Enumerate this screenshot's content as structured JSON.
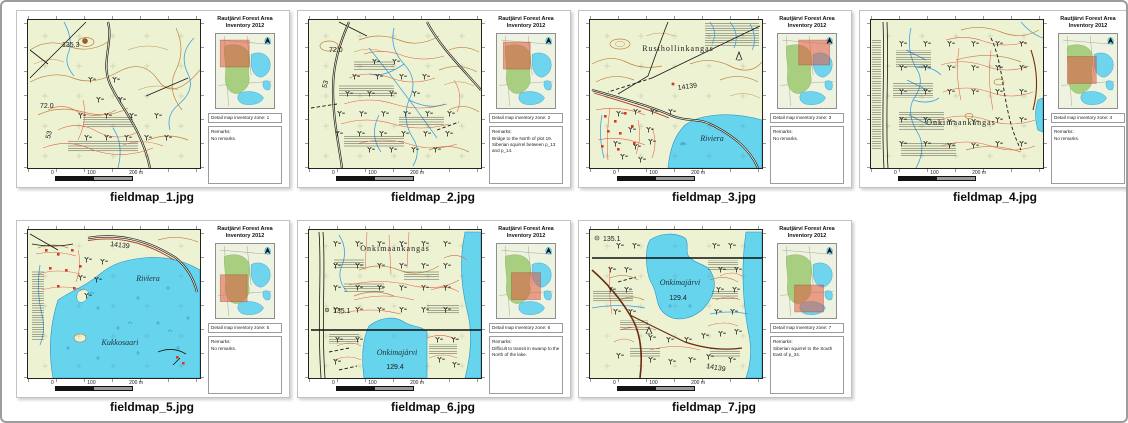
{
  "window": {
    "background": "#ffffff",
    "border_color": "#9c9c9c"
  },
  "card_common": {
    "title_line1": "Rautjärvi Forest Area",
    "title_line2": "Inventory 2012",
    "remarks_heading": "Remarks:",
    "scalebar_ticks": [
      "0",
      "100",
      "200 m"
    ],
    "north_arrow": "north"
  },
  "colors": {
    "map_background": "#edf3d2",
    "lake_fill": "#67d4ee",
    "contour_orange": "#c0813e",
    "detail_red": "#e2604a",
    "stream_blue": "#3f9fe0",
    "road_black": "#161616",
    "overview_forest_green": "#a8cf80",
    "overview_water_cyan": "#6fd4ee",
    "zone_highlight_red": "#e05a43"
  },
  "maps": [
    {
      "caption": "fieldmap_1.jpg",
      "zone_label": "Detail map inventory zone: 1",
      "remarks": "No remarks.",
      "labels": {
        "spot_height": "135.3",
        "contour_elev": "72.0",
        "road_number": "53"
      }
    },
    {
      "caption": "fieldmap_2.jpg",
      "zone_label": "Detail map inventory zone: 2",
      "remarks": "Bridge to the North of plot 19. Siberian squirrel between p_13 and p_14.",
      "labels": {
        "contour_elev": "72.0",
        "road_number": "53"
      }
    },
    {
      "caption": "fieldmap_3.jpg",
      "zone_label": "Detail map inventory zone: 3",
      "remarks": "No remarks.",
      "labels": {
        "area_name": "Rusthollinkangas",
        "road_number": "14139",
        "lake_name": "Riviera"
      }
    },
    {
      "caption": "fieldmap_4.jpg",
      "zone_label": "Detail map inventory zone: 4",
      "remarks": "No remarks.",
      "labels": {
        "area_name": "Onkimaankangas"
      }
    },
    {
      "caption": "fieldmap_5.jpg",
      "zone_label": "Detail map inventory zone: 5",
      "remarks": "No remarks.",
      "labels": {
        "road_number": "14139",
        "lake_name": "Riviera",
        "island_name": "Kukkosaari"
      }
    },
    {
      "caption": "fieldmap_6.jpg",
      "zone_label": "Detail map inventory zone: 6",
      "remarks": "Difficult to transit in swamp to the North of the lake.",
      "labels": {
        "area_name": "Onkimaankangas",
        "spot_height": "135.1",
        "lake_name": "Onkimajärvi",
        "lake_elevation": "129.4"
      }
    },
    {
      "caption": "fieldmap_7.jpg",
      "zone_label": "Detail map inventory zone: 7",
      "remarks": "Siberian squirrel to the South East of p_34.",
      "labels": {
        "spot_height": "135.1",
        "lake_name": "Onkimajärvi",
        "lake_elevation": "129.4",
        "road_number": "14139"
      }
    }
  ]
}
